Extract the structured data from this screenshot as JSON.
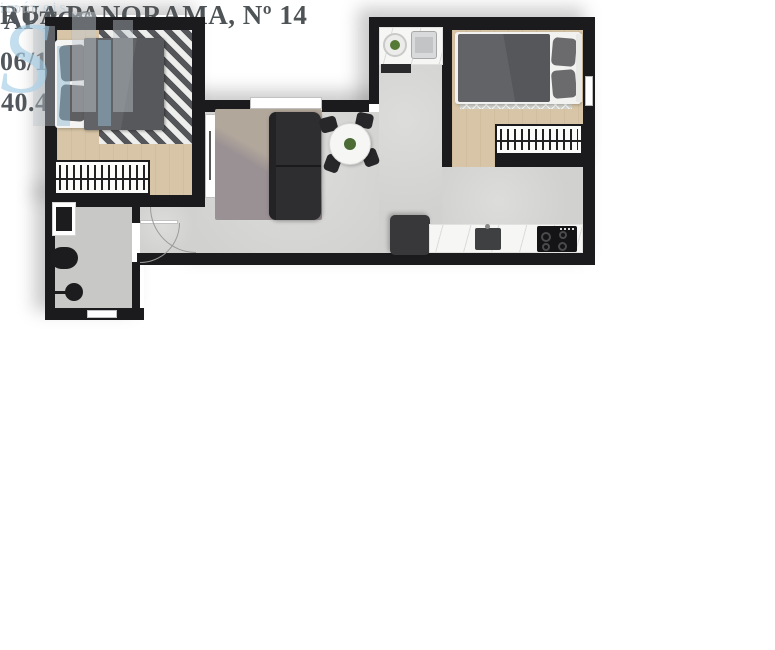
{
  "header": {
    "title": "RUA PANORAMA, Nº 14"
  },
  "unit_info": {
    "label": "APTOS",
    "units": "06/16/26",
    "area": "40.40M²"
  },
  "notes": {
    "header": "*NOTAS:",
    "line1": "AS IMAGENS REFEREM-SE A PLANTA DO APARTAMENTO TIPO, COM SUGESTÃO DE DECORAÇÃO.",
    "line2": "OS MÓVEIS E UTENSILIOS SÃO DE DIMENSÕES COMERCIAIS E NÃO FAZEM PARTE DO CONTRATO."
  },
  "watermark": {
    "letter": "S",
    "name": "imóveis",
    "domain": ".com"
  },
  "colors": {
    "panel_gray": "#b7bdba",
    "title_text": "#4e5356",
    "wall_black": "#1b1b1d",
    "wood_floor": "#d8c5a7",
    "concrete_floor": "#d1d1cf",
    "watermark_blue": "#a6cee6"
  }
}
